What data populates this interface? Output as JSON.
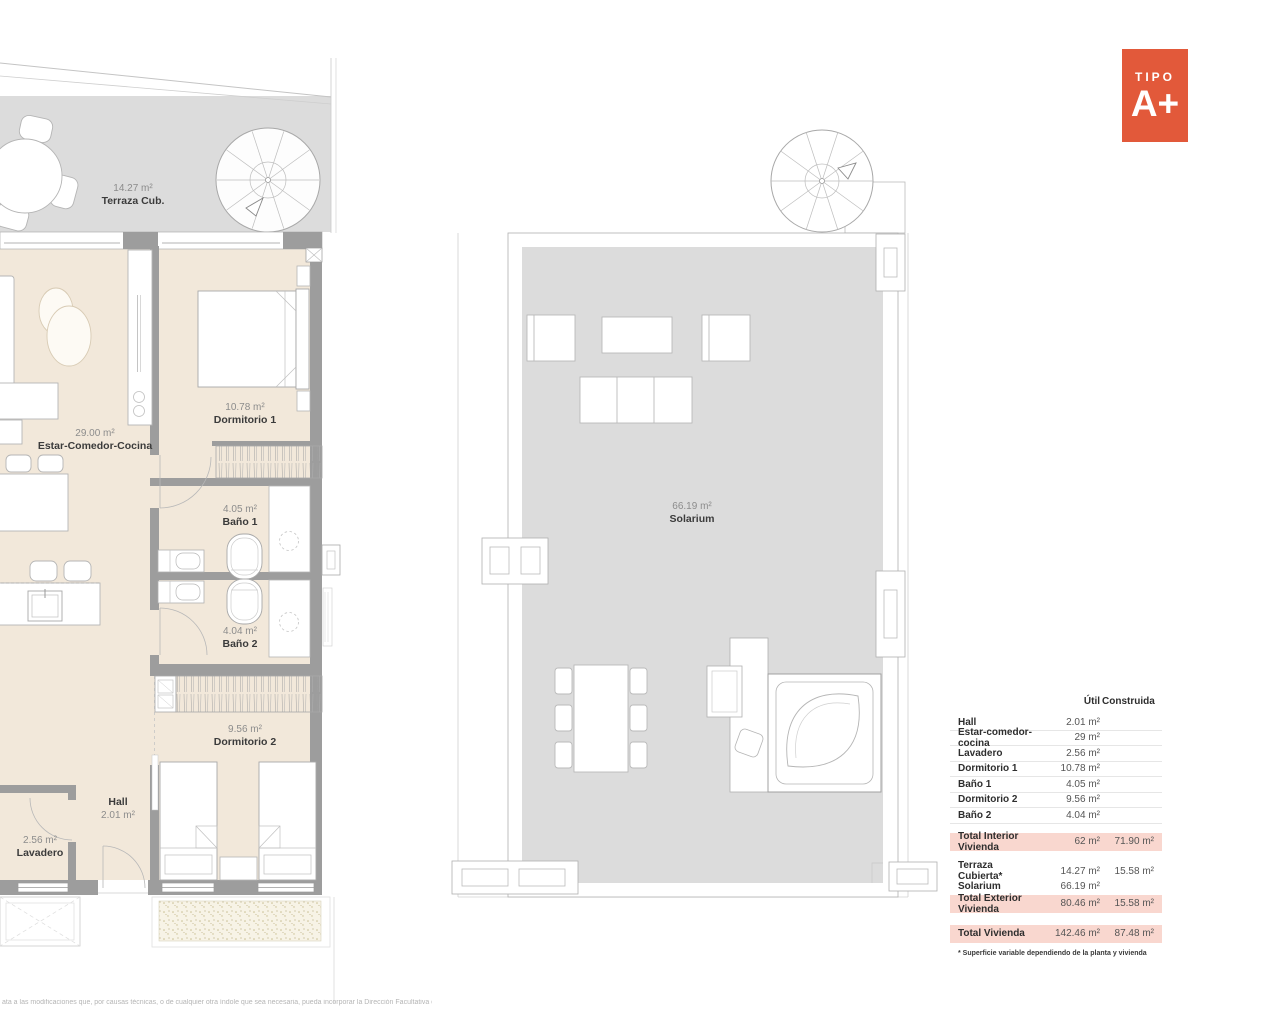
{
  "badge": {
    "label": "TIPO",
    "value": "A+"
  },
  "rooms": {
    "terraza": {
      "area": "14.27 m²",
      "name": "Terraza Cub."
    },
    "estar": {
      "area": "29.00 m²",
      "name": "Estar-Comedor-Cocina"
    },
    "dormitorio1": {
      "area": "10.78 m²",
      "name": "Dormitorio 1"
    },
    "bano1": {
      "area": "4.05 m²",
      "name": "Baño 1"
    },
    "bano2": {
      "area": "4.04 m²",
      "name": "Baño 2"
    },
    "dormitorio2": {
      "area": "9.56 m²",
      "name": "Dormitorio 2"
    },
    "hall": {
      "name": "Hall",
      "area": "2.01 m²"
    },
    "lavadero": {
      "area": "2.56 m²",
      "name": "Lavadero"
    },
    "solarium": {
      "area": "66.19 m²",
      "name": "Solarium"
    }
  },
  "table": {
    "headers": {
      "util": "Útil",
      "construida": "Construida"
    },
    "interior_rows": [
      {
        "label": "Hall",
        "util": "2.01 m²",
        "construida": ""
      },
      {
        "label": "Estar-comedor-cocina",
        "util": "29 m²",
        "construida": ""
      },
      {
        "label": "Lavadero",
        "util": "2.56 m²",
        "construida": ""
      },
      {
        "label": "Dormitorio 1",
        "util": "10.78 m²",
        "construida": ""
      },
      {
        "label": "Baño 1",
        "util": "4.05 m²",
        "construida": ""
      },
      {
        "label": "Dormitorio 2",
        "util": "9.56 m²",
        "construida": ""
      },
      {
        "label": "Baño 2",
        "util": "4.04 m²",
        "construida": ""
      }
    ],
    "total_interior": {
      "label": "Total Interior Vivienda",
      "util": "62 m²",
      "construida": "71.90 m²"
    },
    "exterior_rows": [
      {
        "label": "Terraza Cubierta*",
        "util": "14.27 m²",
        "construida": "15.58 m²"
      },
      {
        "label": "Solarium",
        "util": "66.19 m²",
        "construida": ""
      }
    ],
    "total_exterior": {
      "label": "Total Exterior Vivienda",
      "util": "80.46 m²",
      "construida": "15.58 m²"
    },
    "total": {
      "label": "Total Vivienda",
      "util": "142.46 m²",
      "construida": "87.48 m²"
    },
    "footnote": "* Superficie variable dependiendo de la planta y vivienda"
  },
  "disclaimer": "ata a las modificaciones que, por causas técnicas, o de cualquier otra índole que sea necesaria, pueda incorporar la Dirección Facultativa de la obra.",
  "colors": {
    "accent_orange": "#E2593A",
    "highlight_pink": "#F9D7CF",
    "floor_beige": "#F2E8DA",
    "terrace_gray": "#DCDCDC",
    "wall_gray": "#9D9D9D"
  }
}
